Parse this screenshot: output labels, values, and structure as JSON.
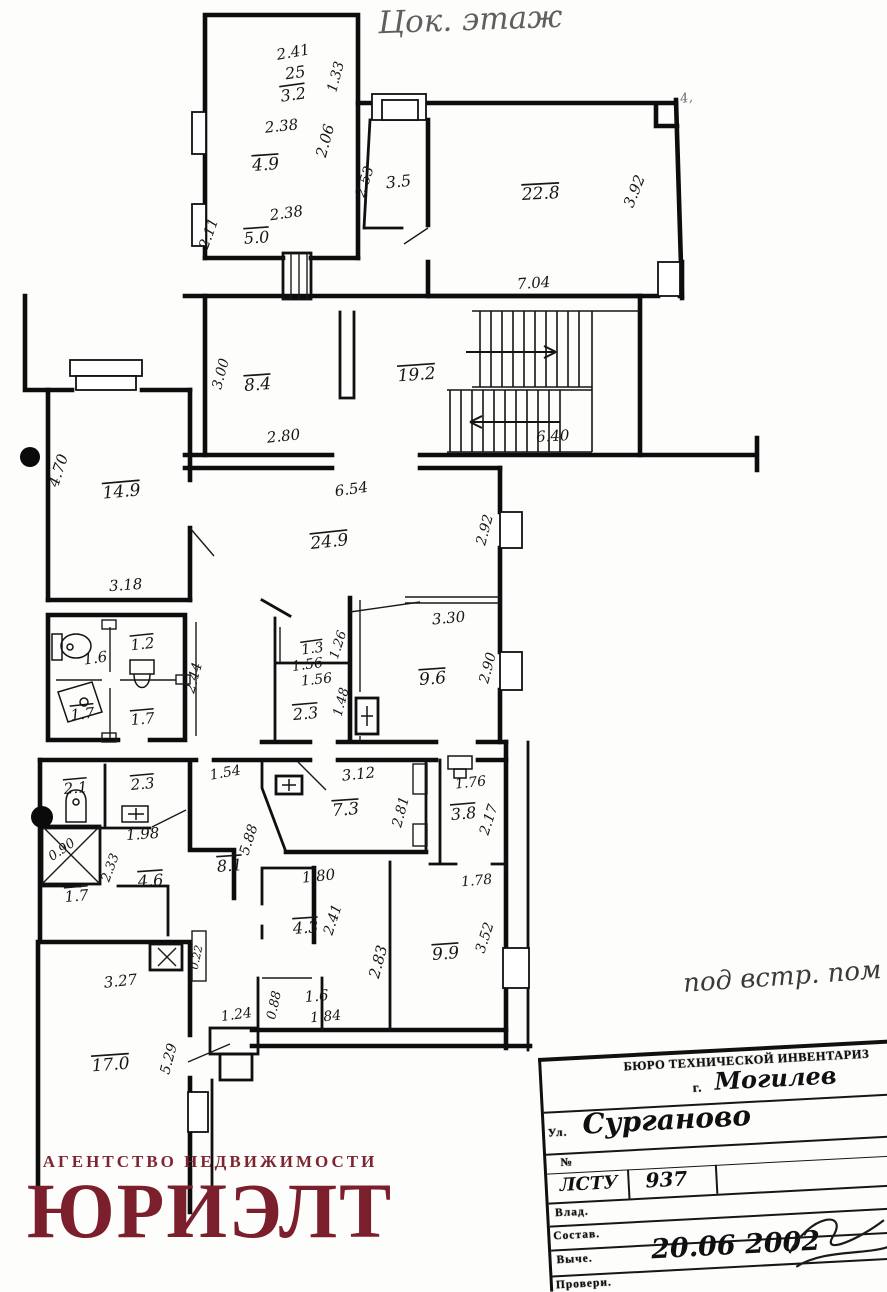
{
  "annotations": {
    "floor_note": "Цок. этаж",
    "right_note": "под встр. пом",
    "corner_tick": "4,"
  },
  "logo": {
    "tagline": "АГЕНТСТВО НЕДВИЖИМОСТИ",
    "name": "ЮРИЭЛТ",
    "color": "#7b1f2c"
  },
  "stamp": {
    "header": "БЮРО ТЕХНИЧЕСКОЙ ИНВЕНТАРИЗ",
    "city_prefix": "г.",
    "city": "Могилев",
    "street_label": "Ул.",
    "street": "Сурганово",
    "number_label": "№",
    "series_label": "ЛСТУ",
    "series_value": "937",
    "owner_label": "Влад.",
    "compiled_label": "Состав.",
    "drawn_label": "Выче.",
    "date": "20.06 2002",
    "checked_label": "Провери."
  },
  "plan": {
    "labels": [
      {
        "t": "2.41",
        "x": 294,
        "y": 57,
        "r": -10,
        "s": 15
      },
      {
        "t": "25",
        "x": 296,
        "y": 78,
        "r": -8,
        "s": 16
      },
      {
        "t": "3.2",
        "x": 294,
        "y": 100,
        "r": -8,
        "s": 16,
        "o": 1
      },
      {
        "t": "1.33",
        "x": 340,
        "y": 78,
        "r": -75,
        "s": 14
      },
      {
        "t": "2.38",
        "x": 282,
        "y": 131,
        "r": -6,
        "s": 15
      },
      {
        "t": "4.9",
        "x": 266,
        "y": 170,
        "r": -4,
        "s": 17,
        "o": 1
      },
      {
        "t": "2.06",
        "x": 330,
        "y": 142,
        "r": -75,
        "s": 15
      },
      {
        "t": "2.38",
        "x": 287,
        "y": 218,
        "r": -8,
        "s": 15
      },
      {
        "t": "5.0",
        "x": 257,
        "y": 243,
        "r": -4,
        "s": 16,
        "o": 1
      },
      {
        "t": "2.11",
        "x": 213,
        "y": 235,
        "r": -70,
        "s": 14
      },
      {
        "t": "2.53",
        "x": 369,
        "y": 183,
        "r": -72,
        "s": 14
      },
      {
        "t": "3.5",
        "x": 399,
        "y": 187,
        "r": -6,
        "s": 16
      },
      {
        "t": "22.8",
        "x": 541,
        "y": 199,
        "r": -3,
        "s": 17,
        "o": 1
      },
      {
        "t": "3.92",
        "x": 639,
        "y": 193,
        "r": -68,
        "s": 15
      },
      {
        "t": "7.04",
        "x": 534,
        "y": 288,
        "r": -4,
        "s": 15
      },
      {
        "t": "4,",
        "x": 687,
        "y": 102,
        "r": -10,
        "s": 13,
        "p": 1
      },
      {
        "t": "19.2",
        "x": 417,
        "y": 380,
        "r": -4,
        "s": 17,
        "o": 1
      },
      {
        "t": "6.40",
        "x": 553,
        "y": 441,
        "r": -3,
        "s": 15
      },
      {
        "t": "8.4",
        "x": 258,
        "y": 390,
        "r": -4,
        "s": 17,
        "o": 1
      },
      {
        "t": "3.00",
        "x": 225,
        "y": 375,
        "r": -75,
        "s": 14
      },
      {
        "t": "2.80",
        "x": 284,
        "y": 441,
        "r": -6,
        "s": 15
      },
      {
        "t": "4.70",
        "x": 63,
        "y": 472,
        "r": -72,
        "s": 15
      },
      {
        "t": "14.9",
        "x": 122,
        "y": 497,
        "r": -5,
        "s": 17,
        "o": 1
      },
      {
        "t": "3.18",
        "x": 126,
        "y": 590,
        "r": -4,
        "s": 15
      },
      {
        "t": "6.54",
        "x": 352,
        "y": 494,
        "r": -8,
        "s": 15
      },
      {
        "t": "24.9",
        "x": 330,
        "y": 547,
        "r": -6,
        "s": 17,
        "o": 1
      },
      {
        "t": "2.92",
        "x": 489,
        "y": 531,
        "r": -75,
        "s": 14
      },
      {
        "t": "3.30",
        "x": 449,
        "y": 623,
        "r": -5,
        "s": 15
      },
      {
        "t": "9.6",
        "x": 433,
        "y": 684,
        "r": -4,
        "s": 17,
        "o": 1
      },
      {
        "t": "2.90",
        "x": 492,
        "y": 669,
        "r": -75,
        "s": 14
      },
      {
        "t": "1.6",
        "x": 96,
        "y": 663,
        "r": -8,
        "s": 15
      },
      {
        "t": "1.2",
        "x": 143,
        "y": 649,
        "r": -6,
        "s": 15,
        "o": 1
      },
      {
        "t": "1.7",
        "x": 83,
        "y": 719,
        "r": -6,
        "s": 15,
        "o": 1
      },
      {
        "t": "1.7",
        "x": 143,
        "y": 724,
        "r": -5,
        "s": 15,
        "o": 1
      },
      {
        "t": "2.44",
        "x": 198,
        "y": 679,
        "r": -75,
        "s": 14
      },
      {
        "t": "1.3",
        "x": 313,
        "y": 653,
        "r": -8,
        "s": 14,
        "o": 1
      },
      {
        "t": "1.56",
        "x": 308,
        "y": 669,
        "r": -8,
        "s": 14
      },
      {
        "t": "1.26",
        "x": 342,
        "y": 646,
        "r": -72,
        "s": 13
      },
      {
        "t": "1.56",
        "x": 317,
        "y": 684,
        "r": -6,
        "s": 14
      },
      {
        "t": "2.3",
        "x": 306,
        "y": 719,
        "r": -5,
        "s": 16,
        "o": 1
      },
      {
        "t": "1.48",
        "x": 345,
        "y": 703,
        "r": -75,
        "s": 13
      },
      {
        "t": "2.1",
        "x": 76,
        "y": 793,
        "r": -5,
        "s": 15,
        "o": 1
      },
      {
        "t": "2.3",
        "x": 143,
        "y": 789,
        "r": -5,
        "s": 15,
        "o": 1
      },
      {
        "t": "1.98",
        "x": 143,
        "y": 839,
        "r": -4,
        "s": 15
      },
      {
        "t": "0.90",
        "x": 64,
        "y": 853,
        "r": -35,
        "s": 13
      },
      {
        "t": "2.33",
        "x": 114,
        "y": 869,
        "r": -70,
        "s": 13
      },
      {
        "t": "4.6",
        "x": 151,
        "y": 886,
        "r": -4,
        "s": 16,
        "o": 1
      },
      {
        "t": "1.7",
        "x": 77,
        "y": 901,
        "r": -5,
        "s": 15,
        "o": 1
      },
      {
        "t": "8.1",
        "x": 230,
        "y": 871,
        "r": -4,
        "s": 16,
        "o": 1
      },
      {
        "t": "5.88",
        "x": 253,
        "y": 841,
        "r": -72,
        "s": 14
      },
      {
        "t": "1.54",
        "x": 226,
        "y": 777,
        "r": -10,
        "s": 14
      },
      {
        "t": "3.12",
        "x": 359,
        "y": 779,
        "r": -6,
        "s": 15
      },
      {
        "t": "7.3",
        "x": 346,
        "y": 815,
        "r": -4,
        "s": 17,
        "o": 1
      },
      {
        "t": "2.81",
        "x": 405,
        "y": 813,
        "r": -75,
        "s": 14
      },
      {
        "t": "1.76",
        "x": 471,
        "y": 787,
        "r": -6,
        "s": 14
      },
      {
        "t": "3.8",
        "x": 464,
        "y": 819,
        "r": -5,
        "s": 16,
        "o": 1
      },
      {
        "t": "2.17",
        "x": 493,
        "y": 821,
        "r": -72,
        "s": 14
      },
      {
        "t": "1.78",
        "x": 477,
        "y": 885,
        "r": -5,
        "s": 14
      },
      {
        "t": "1.80",
        "x": 319,
        "y": 881,
        "r": -6,
        "s": 15
      },
      {
        "t": "4.3",
        "x": 306,
        "y": 933,
        "r": -4,
        "s": 16,
        "o": 1
      },
      {
        "t": "2.41",
        "x": 337,
        "y": 921,
        "r": -72,
        "s": 14
      },
      {
        "t": "2.83",
        "x": 383,
        "y": 963,
        "r": -75,
        "s": 15
      },
      {
        "t": "9.9",
        "x": 446,
        "y": 959,
        "r": -4,
        "s": 17,
        "o": 1
      },
      {
        "t": "3.52",
        "x": 489,
        "y": 939,
        "r": -72,
        "s": 14
      },
      {
        "t": "1.6",
        "x": 317,
        "y": 1001,
        "r": -5,
        "s": 15
      },
      {
        "t": "1.84",
        "x": 326,
        "y": 1021,
        "r": -5,
        "s": 14
      },
      {
        "t": "0.88",
        "x": 278,
        "y": 1006,
        "r": -78,
        "s": 13
      },
      {
        "t": "1.24",
        "x": 237,
        "y": 1019,
        "r": -8,
        "s": 14
      },
      {
        "t": "3.27",
        "x": 121,
        "y": 986,
        "r": -6,
        "s": 15
      },
      {
        "t": "17.0",
        "x": 111,
        "y": 1070,
        "r": -4,
        "s": 17,
        "o": 1
      },
      {
        "t": "5.29",
        "x": 173,
        "y": 1060,
        "r": -75,
        "s": 14
      },
      {
        "t": "0.22",
        "x": 200,
        "y": 958,
        "r": -78,
        "s": 11
      }
    ]
  }
}
